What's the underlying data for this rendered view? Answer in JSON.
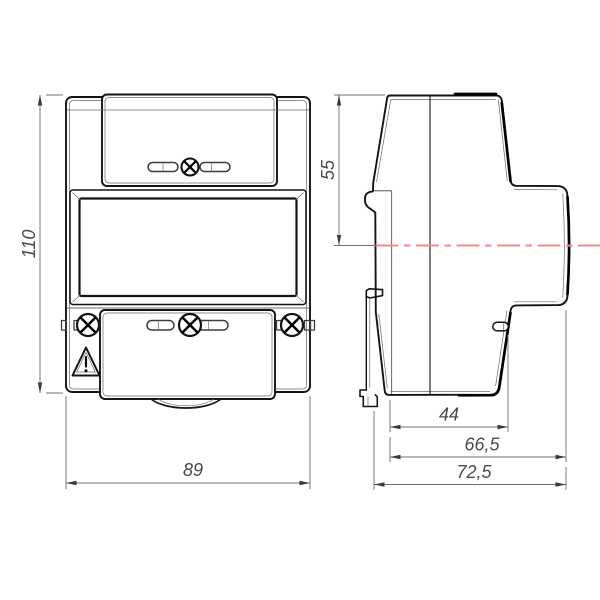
{
  "drawing": {
    "type": "engineering-dimension-drawing",
    "subject": "din-rail-mounted-meter",
    "views": {
      "front_view": "front view with display window, sealed screw covers and warning symbol",
      "side_view": "side profile with DIN-rail clip and red mounting centerline"
    },
    "dimensions": {
      "front_height": "110",
      "front_width": "89",
      "side_top_to_rail_axis": "55",
      "side_rear_housing_depth": "44",
      "side_body_depth": "66,5",
      "side_overall_depth": "72,5"
    },
    "icons": {
      "warning": "warning-triangle-icon",
      "screw": "phillips-screw-icon",
      "seal_slot": "seal-slot-icon"
    },
    "colors": {
      "object_line": "#141414",
      "thick_line": "#000000",
      "dimension_line": "#6f6f6f",
      "dimension_text": "#4a4a4a",
      "centerline_red": "#f28a8a",
      "background": "#ffffff"
    }
  }
}
